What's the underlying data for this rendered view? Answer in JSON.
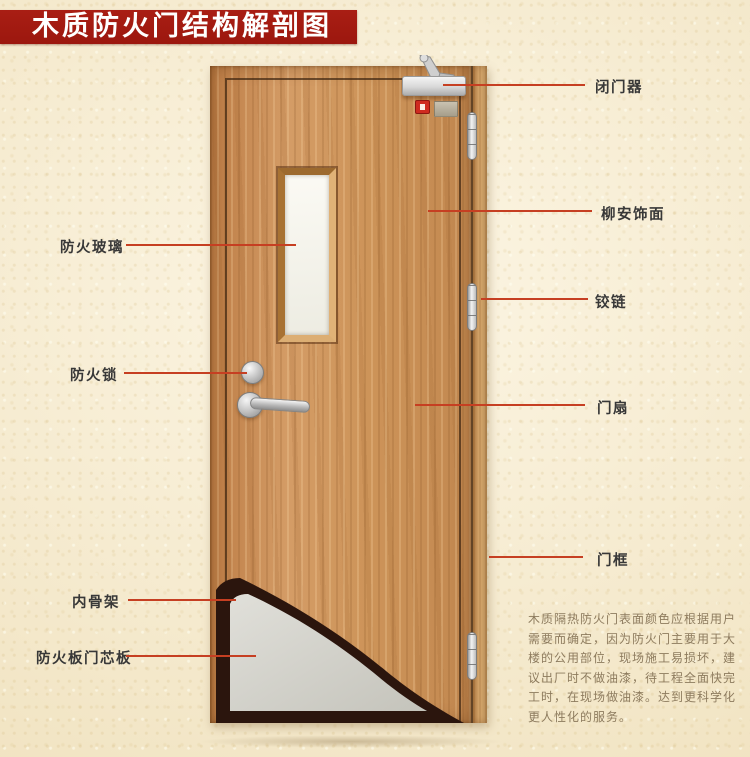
{
  "banner": {
    "title": "木质防火门结构解剖图"
  },
  "diagram": {
    "labels_left": [
      {
        "id": "fire-glass",
        "text": "防火玻璃"
      },
      {
        "id": "fire-lock",
        "text": "防火锁"
      },
      {
        "id": "inner-skeleton",
        "text": "内骨架"
      },
      {
        "id": "fire-board-core",
        "text": "防火板门芯板"
      }
    ],
    "labels_right": [
      {
        "id": "door-closer",
        "text": "闭门器"
      },
      {
        "id": "lauan-veneer",
        "text": "柳安饰面"
      },
      {
        "id": "hinge",
        "text": "铰链"
      },
      {
        "id": "door-leaf",
        "text": "门扇"
      },
      {
        "id": "door-frame",
        "text": "门框"
      }
    ],
    "note_lines": [
      "木质隔热防火门表面颜色应根据用户",
      "需要而确定，因为防火门主要用于大",
      "楼的公用部位，现场施工易损坏，建",
      "议出厂时不做油漆，待工程全面快完",
      "工时，在现场做油漆。达到更科学化",
      "更人性化的服务。"
    ],
    "colors": {
      "banner": "#9c170e",
      "leader_line": "#c63f22",
      "label_text": "#383838",
      "note_text": "#8d7b5e",
      "door_wood": "#cd9459",
      "frame_wood": "#d8a96e",
      "cutaway_dark": "#2b150d",
      "core_gray": "#d6d5cd",
      "background": "#f4e9cd"
    }
  }
}
